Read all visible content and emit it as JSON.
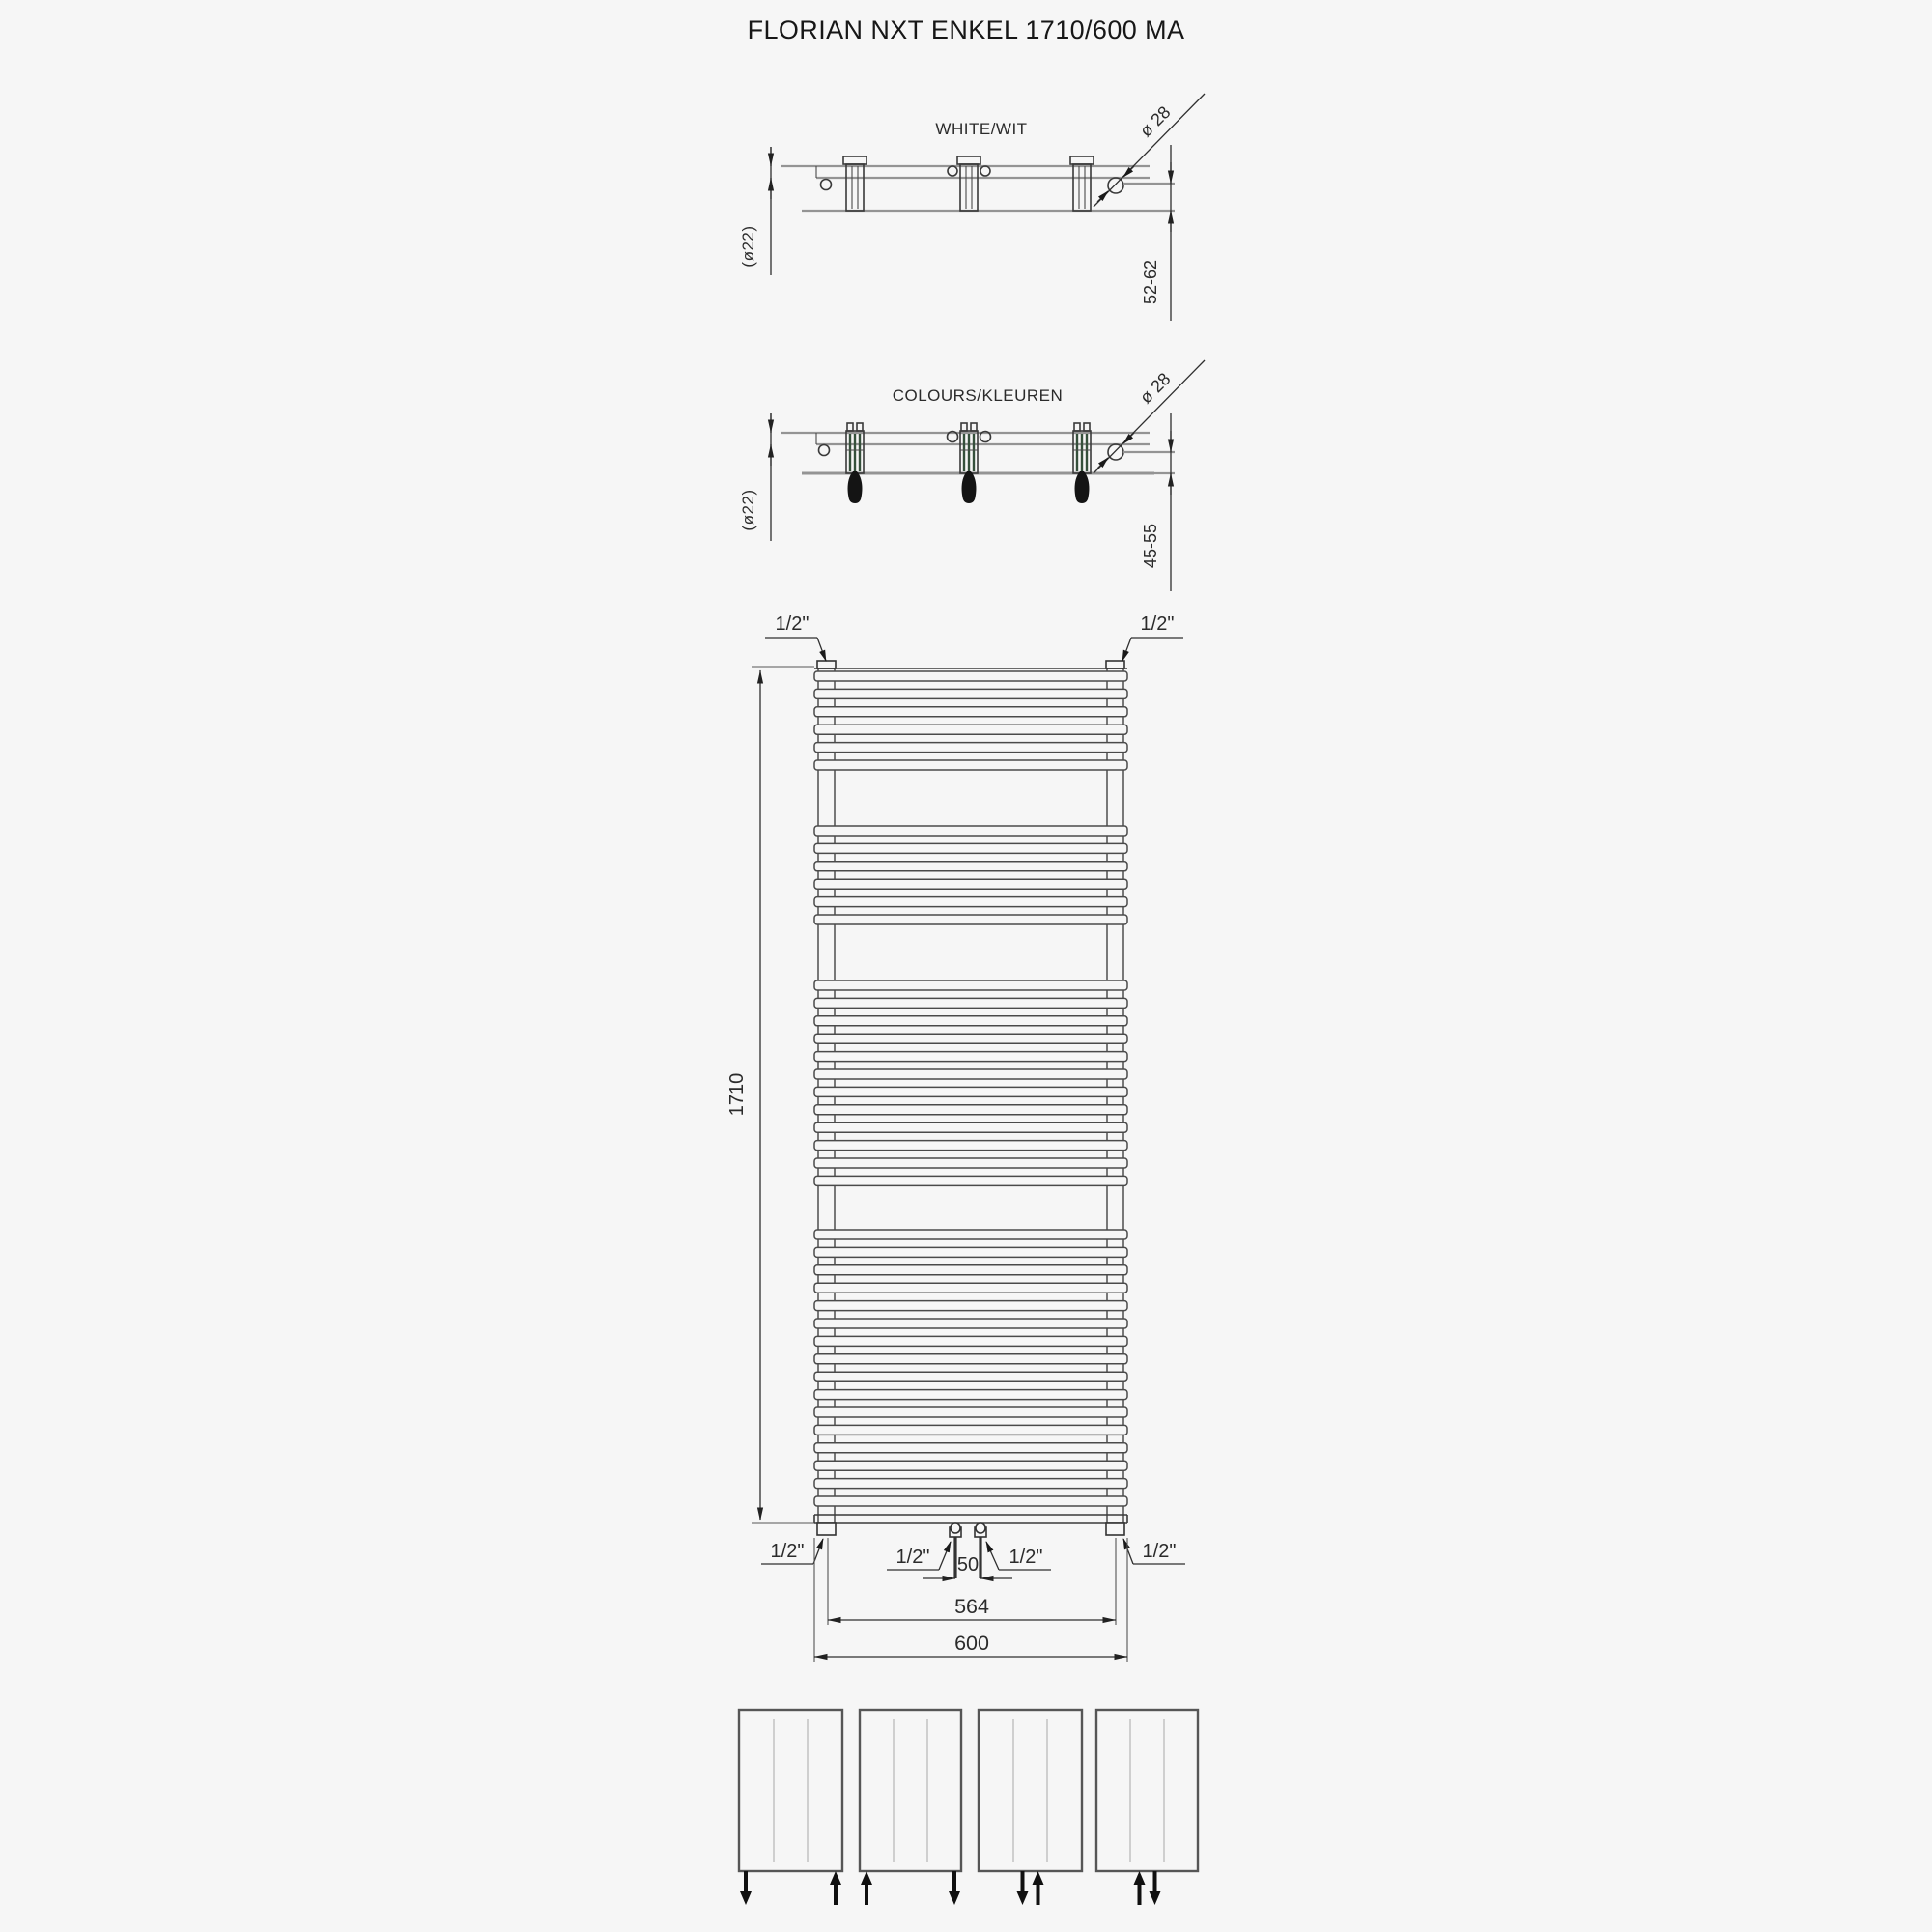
{
  "title": "FLORIAN NXT ENKEL 1710/600 MA",
  "colors": {
    "background": "#f6f6f6",
    "line": "#3a3a3a",
    "light_line": "#949494",
    "arrow_black": "#101010",
    "bracket_green": "#35503b"
  },
  "views": {
    "side_white": {
      "label": "WHITE/WIT",
      "tube_diameter": "(ø22)",
      "bracket_diameter": "ø 28",
      "wall_distance_range": "52-62"
    },
    "side_colours": {
      "label": "COLOURS/KLEUREN",
      "tube_diameter": "(ø22)",
      "bracket_diameter": "ø 28",
      "wall_distance_range": "45-55"
    },
    "front": {
      "height_mm": "1710",
      "overall_width_mm": "600",
      "connection_width_mm": "564",
      "center_distance_mm": "50",
      "thread_size": "1/2\"",
      "rung_groups": [
        6,
        6,
        12,
        16
      ]
    }
  },
  "connection_options": [
    {
      "name": "bottom-left-in-right-out",
      "arrows": [
        {
          "slot": "left",
          "dir": "down"
        },
        {
          "slot": "right",
          "dir": "up"
        }
      ]
    },
    {
      "name": "bottom-left-out-right-in",
      "arrows": [
        {
          "slot": "left",
          "dir": "up"
        },
        {
          "slot": "right",
          "dir": "down"
        }
      ]
    },
    {
      "name": "bottom-center-in-out",
      "arrows": [
        {
          "slot": "center-left",
          "dir": "down"
        },
        {
          "slot": "center-right",
          "dir": "up"
        }
      ]
    },
    {
      "name": "bottom-center-out-in",
      "arrows": [
        {
          "slot": "center-left",
          "dir": "up"
        },
        {
          "slot": "center-right",
          "dir": "down"
        }
      ]
    }
  ]
}
